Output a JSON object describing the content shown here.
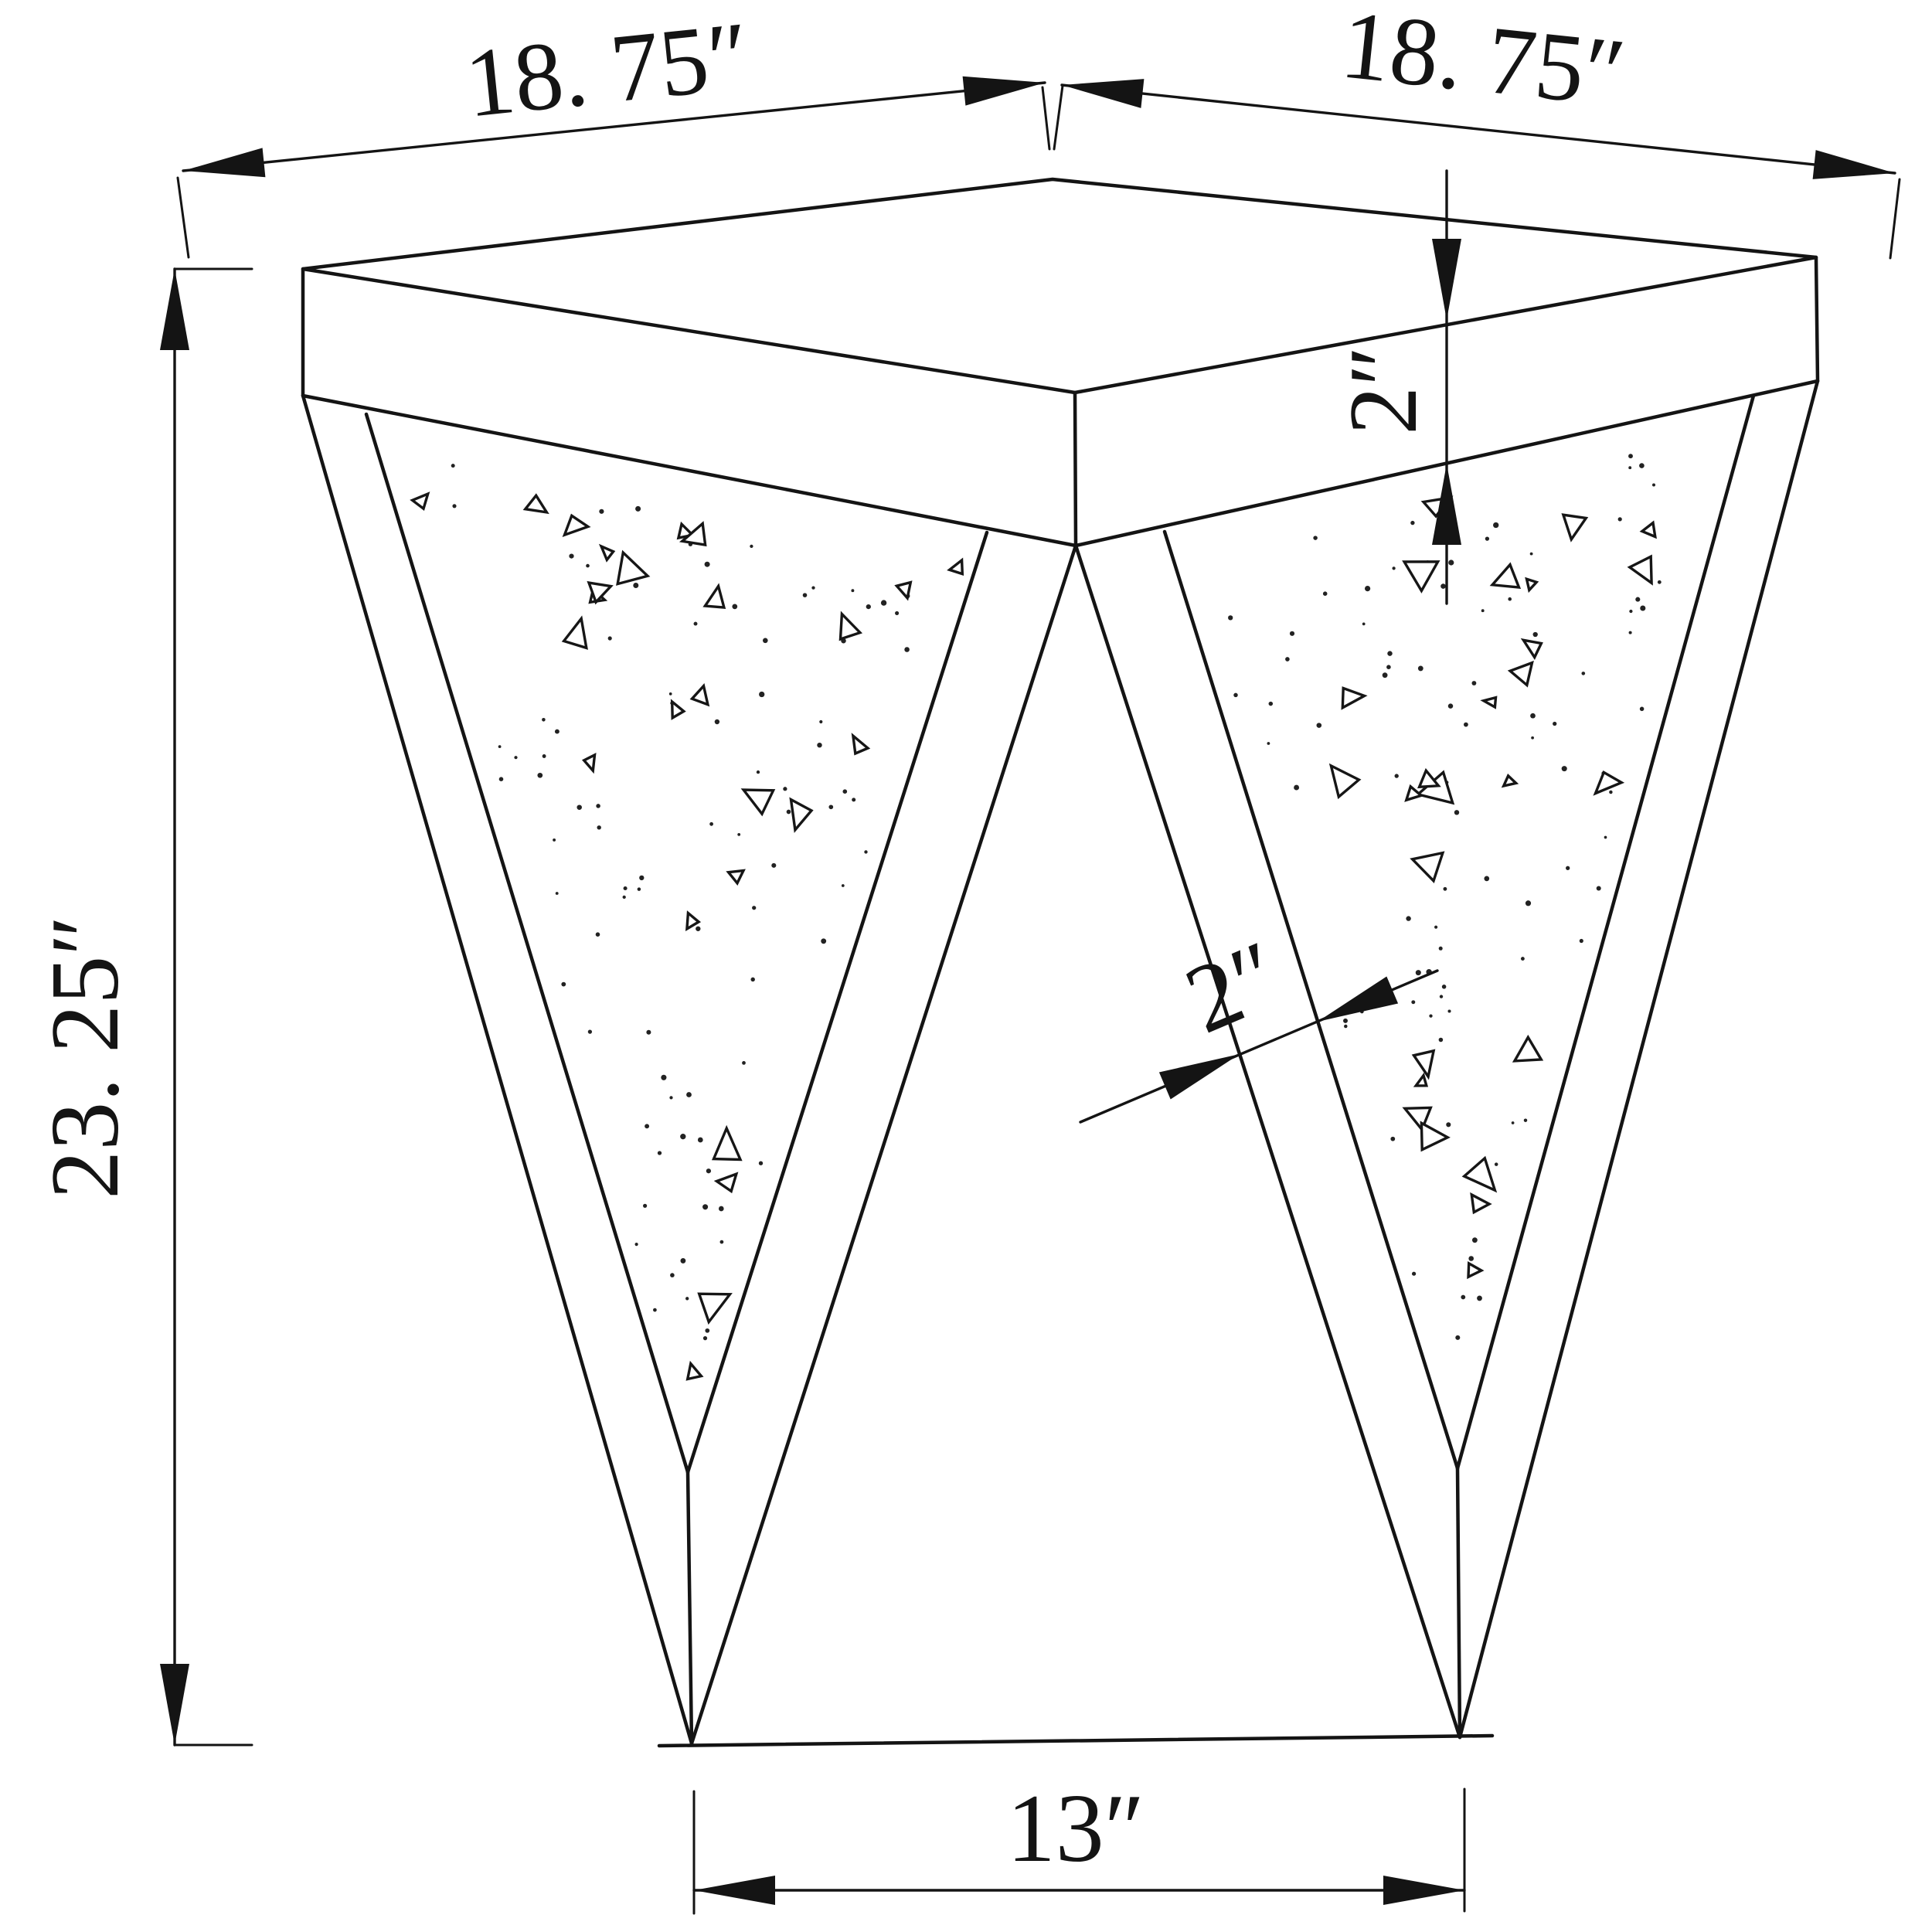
{
  "drawing": {
    "subject": "square accent end table with two V-shaped speckled legs, isometric technical drawing",
    "background": "#ffffff",
    "line_color": "#141414",
    "unit": "in"
  },
  "dimensions": {
    "top_edge_left": {
      "label": "18. 75″",
      "value": 18.75,
      "unit": "in"
    },
    "top_edge_right": {
      "label": "18. 75″",
      "value": 18.75,
      "unit": "in"
    },
    "overall_height": {
      "label": "23. 25″",
      "value": 23.25,
      "unit": "in"
    },
    "top_thickness": {
      "label": "2″",
      "value": 2,
      "unit": "in"
    },
    "leg_frame_width": {
      "label": "2″",
      "value": 2,
      "unit": "in"
    },
    "bottom_span": {
      "label": "13″",
      "value": 13,
      "unit": "in"
    }
  },
  "texture": {
    "dots_per_panel": 85,
    "triangles_per_panel": 26,
    "seed": 20240601,
    "panel_left": [
      [
        474,
        536
      ],
      [
        1277,
        689
      ],
      [
        890,
        1905
      ]
    ],
    "panel_right": [
      [
        1507,
        688
      ],
      [
        2269,
        512
      ],
      [
        1886,
        1900
      ]
    ]
  }
}
